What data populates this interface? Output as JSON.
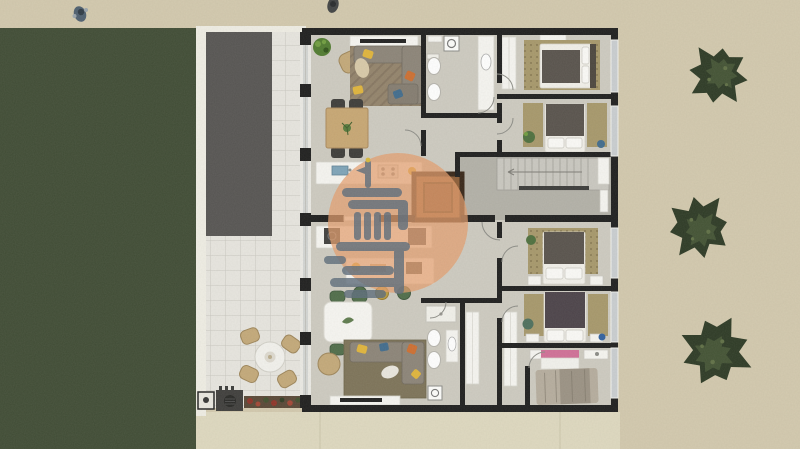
{
  "meta": {
    "kind": "architectural floor plan render",
    "view": "top-down 2D color site plan",
    "canvas": "800x449"
  },
  "colors": {
    "sand": "#d2c8ad",
    "lawn": "#3e4a33",
    "driveway": "#555351",
    "patio_tile": "#e7e5df",
    "tile_grout": "#c9c7c0",
    "boundary_wall": "#efede4",
    "path_cream": "#ded8bf",
    "wall": "#1c1c1c",
    "floor": "#cdcac0",
    "hall_floor": "#b2b0a7",
    "glass": "#c9cdd0",
    "facade": "#eae9e4",
    "wood_table": "#c7a672",
    "chair_dark": "#3b3a37",
    "chair_green": "#4e6b48",
    "sofa": "#8b8377",
    "rug_brown": "#92826a",
    "rug_olive": "#7c7257",
    "rug_tan": "#a6976a",
    "bed_dark": "#57514b",
    "bed_plum": "#4a4148",
    "linen": "#f1efe9",
    "fixture_white": "#f6f5f1",
    "elevator_wood": "#8b5c36",
    "elevator_wall": "#362416",
    "tree_dark": "#2b3823",
    "tree_light": "#4a5a38",
    "watermark": "#e59c6b",
    "logo": "#5c6b7a",
    "accent_yellow": "#e0b43a",
    "accent_orange": "#cd6d2f",
    "accent_blue": "#3f6a8c",
    "accent_pink": "#d06e96",
    "flower_red": "#8d3126",
    "grill_dark": "#3d3c3a"
  },
  "site": {
    "areas": [
      "pedestrian walkway (top)",
      "lawn (left)",
      "gravel driveway",
      "tiled terrace with outdoor dining",
      "sand garden (right)",
      "concrete path (bottom)"
    ],
    "tree_count": 3,
    "person_count": 2,
    "outdoor_furniture": [
      "round patio table",
      "4 wicker chairs",
      "barbecue grill counter",
      "outdoor sink",
      "flower bed"
    ]
  },
  "building": {
    "core": {
      "elevator": true,
      "staircase": true
    },
    "apartments": [
      {
        "name": "upper apartment",
        "rooms": [
          "living-dining room with sofa, rug, TV sideboard, dining table for 4, kitchen counter",
          "bathroom with washing machine, vanity, toilet, bidet",
          "hallway",
          "bedroom 1 with double bed, wardrobe, dotted rug",
          "bedroom 2 with double bed, two runner rugs, plant"
        ]
      },
      {
        "name": "lower apartment",
        "rooms": [
          "kitchen with counter, island and 3 stools",
          "dining area with white table and 4 green chairs",
          "living room with sofa, olive rug, TV sideboard, pouf",
          "bathroom with shower, toilet, bidet, vanity, washer",
          "hallway with closets",
          "bedroom 3 with double bed and dotted rug",
          "bedroom 4 with double bed and two runner rugs",
          "bedroom 5 with unmade bed and two desks"
        ]
      }
    ]
  },
  "watermark": {
    "shape": "semi-transparent orange circle",
    "logo": "slate stylized lighthouse-tower monogram"
  }
}
